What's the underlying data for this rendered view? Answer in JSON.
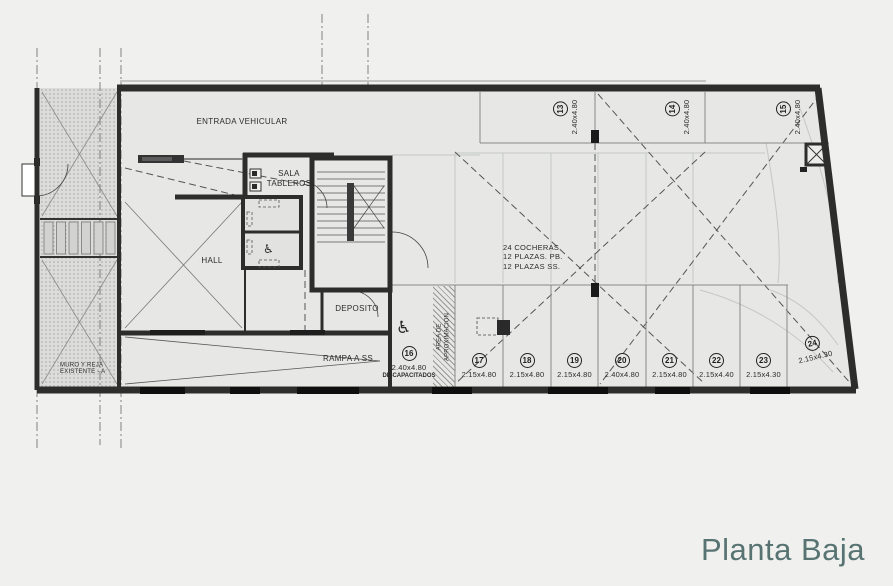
{
  "title": {
    "text": "Planta Baja",
    "color": "#587472"
  },
  "colors": {
    "wall": "#2d2d2b",
    "plan_background": "#e7e8e6",
    "title": "#587472"
  },
  "plan_labels": {
    "entrada_vehicular": "ENTRADA VEHICULAR",
    "sala_tableros_line1": "SALA",
    "sala_tableros_line2": "TABLEROS",
    "hall": "HALL",
    "deposito": "DEPOSITO",
    "rampa_ss": "RAMPA A SS",
    "muro_line1": "MURO Y REJA",
    "muro_line2": "EXISTENTE - A",
    "area_aprox_line1": "AREA DE",
    "area_aprox_line2": "APROXIMACION",
    "cocheras_line1": "24 COCHERAS",
    "cocheras_line2": "12 PLAZAS. PB.",
    "cocheras_line3": "12 PLAZAS SS."
  },
  "icons": {
    "wheelchair": "♿"
  },
  "parking_spots_top": [
    {
      "num": "13",
      "dim": "2.40x4.80"
    },
    {
      "num": "14",
      "dim": "2.40x4.80"
    },
    {
      "num": "15",
      "dim": "2.40x4.80"
    }
  ],
  "parking_spots_bottom": [
    {
      "num": "16",
      "dim": "2.40x4.80",
      "note": "DISCAPACITADOS"
    },
    {
      "num": "17",
      "dim": "2.15x4.80"
    },
    {
      "num": "18",
      "dim": "2.15x4.80"
    },
    {
      "num": "19",
      "dim": "2.15x4.80"
    },
    {
      "num": "20",
      "dim": "2.40x4.80"
    },
    {
      "num": "21",
      "dim": "2.15x4.80"
    },
    {
      "num": "22",
      "dim": "2.15x4.40"
    },
    {
      "num": "23",
      "dim": "2.15x4.30"
    },
    {
      "num": "24",
      "dim": "2.15x4.30"
    }
  ]
}
